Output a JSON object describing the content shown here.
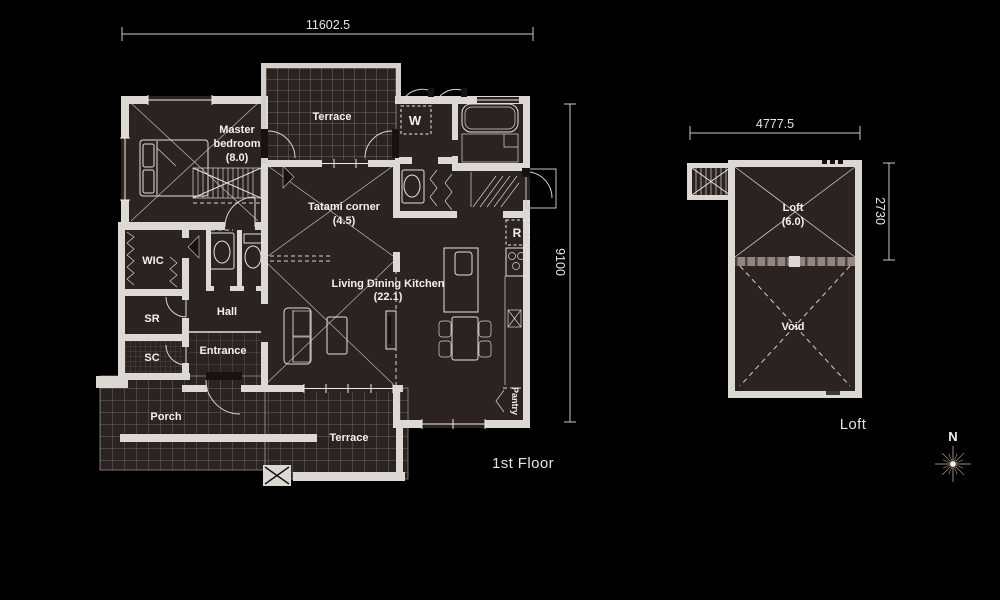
{
  "first_floor": {
    "dim_width": "11602.5",
    "dim_height": "9100",
    "caption": "1st Floor",
    "rooms": {
      "master_line1": "Master",
      "master_line2": "bedroom",
      "master_size": "(8.0)",
      "terrace_top": "Terrace",
      "washer": "W",
      "tatami_line1": "Tatami corner",
      "tatami_size": "(4.5)",
      "fridge": "R",
      "ldk_line1": "Living Dining Kitchen",
      "ldk_size": "(22.1)",
      "wic": "WIC",
      "sr": "SR",
      "sc": "SC",
      "hall": "Hall",
      "entrance": "Entrance",
      "porch": "Porch",
      "terrace_bottom": "Terrace",
      "pantry": "Pantry"
    }
  },
  "loft_plan": {
    "dim_width": "4777.5",
    "dim_height": "2730",
    "caption": "Loft",
    "rooms": {
      "loft_line1": "Loft",
      "loft_size": "(6.0)",
      "void": "Void"
    }
  },
  "compass": {
    "north": "N"
  },
  "colors": {
    "background": "#000000",
    "wall": "#dcd8d4",
    "floor": "#2b2321",
    "linework": "#e6e2dc",
    "grid": "#837b73",
    "label_text": "#f3f0ec",
    "compass_rays": "#97887a"
  }
}
